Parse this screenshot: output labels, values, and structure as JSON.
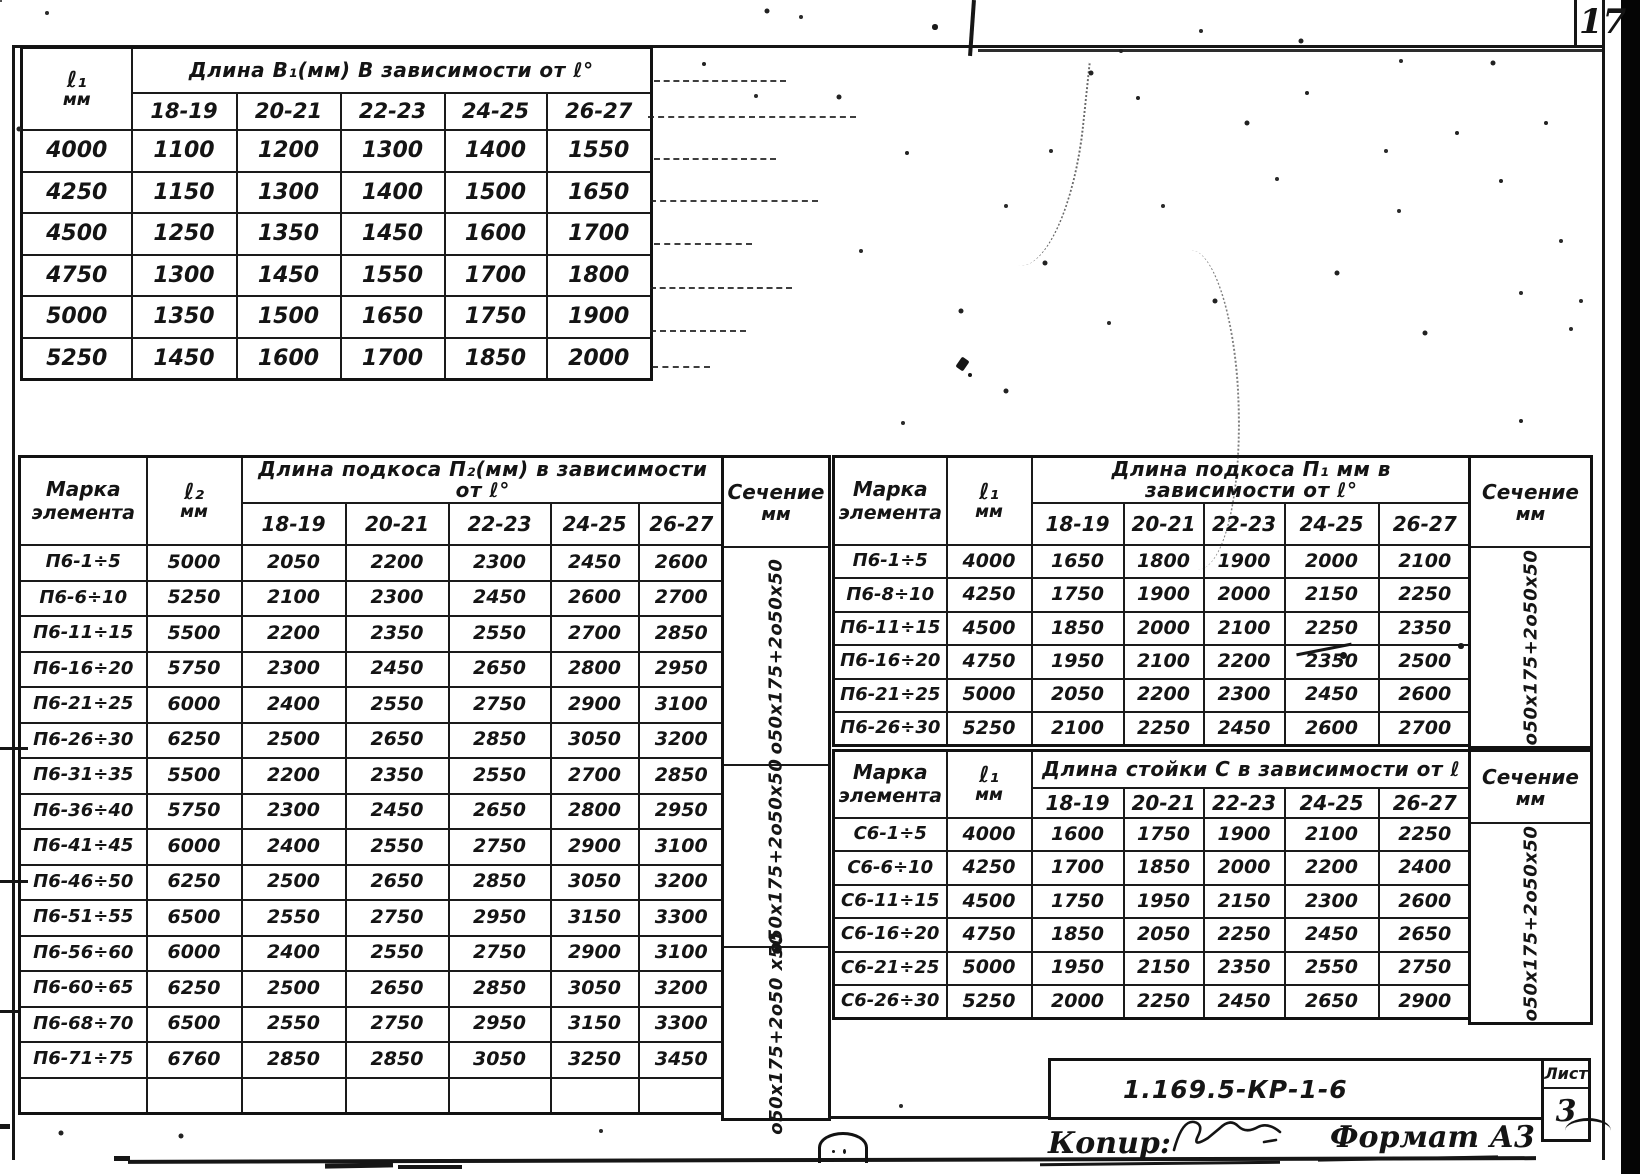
{
  "page": {
    "page_number": "17"
  },
  "top_table": {
    "corner_line1": "ℓ₁",
    "corner_line2": "мм",
    "title": "Длина В₁(мм) В зависимости от ℓ°",
    "col_headers": [
      "18-19",
      "20-21",
      "22-23",
      "24-25",
      "26-27"
    ],
    "rows": [
      {
        "label": "4000",
        "values": [
          "1100",
          "1200",
          "1300",
          "1400",
          "1550"
        ]
      },
      {
        "label": "4250",
        "values": [
          "1150",
          "1300",
          "1400",
          "1500",
          "1650"
        ]
      },
      {
        "label": "4500",
        "values": [
          "1250",
          "1350",
          "1450",
          "1600",
          "1700"
        ]
      },
      {
        "label": "4750",
        "values": [
          "1300",
          "1450",
          "1550",
          "1700",
          "1800"
        ]
      },
      {
        "label": "5000",
        "values": [
          "1350",
          "1500",
          "1650",
          "1750",
          "1900"
        ]
      },
      {
        "label": "5250",
        "values": [
          "1450",
          "1600",
          "1700",
          "1850",
          "2000"
        ]
      }
    ]
  },
  "left_table": {
    "marka_line1": "Марка",
    "marka_line2": "элемента",
    "l_line1": "ℓ₂",
    "l_line2": "мм",
    "title": "Длина подкоса П₂(мм) в зависимости от ℓ°",
    "col_headers": [
      "18-19",
      "20-21",
      "22-23",
      "24-25",
      "26-27"
    ],
    "sechenie_line1": "Сечение",
    "sechenie_line2": "мм",
    "sechenie_groups": [
      "о50х175+2о50х50",
      "о50х175+2о50х50",
      "о50х175+2о50 х50"
    ],
    "rows": [
      {
        "marka": "П6-1÷5",
        "l": "5000",
        "values": [
          "2050",
          "2200",
          "2300",
          "2450",
          "2600"
        ]
      },
      {
        "marka": "П6-6÷10",
        "l": "5250",
        "values": [
          "2100",
          "2300",
          "2450",
          "2600",
          "2700"
        ]
      },
      {
        "marka": "П6-11÷15",
        "l": "5500",
        "values": [
          "2200",
          "2350",
          "2550",
          "2700",
          "2850"
        ]
      },
      {
        "marka": "П6-16÷20",
        "l": "5750",
        "values": [
          "2300",
          "2450",
          "2650",
          "2800",
          "2950"
        ]
      },
      {
        "marka": "П6-21÷25",
        "l": "6000",
        "values": [
          "2400",
          "2550",
          "2750",
          "2900",
          "3100"
        ]
      },
      {
        "marka": "П6-26÷30",
        "l": "6250",
        "values": [
          "2500",
          "2650",
          "2850",
          "3050",
          "3200"
        ]
      },
      {
        "marka": "П6-31÷35",
        "l": "5500",
        "values": [
          "2200",
          "2350",
          "2550",
          "2700",
          "2850"
        ]
      },
      {
        "marka": "П6-36÷40",
        "l": "5750",
        "values": [
          "2300",
          "2450",
          "2650",
          "2800",
          "2950"
        ]
      },
      {
        "marka": "П6-41÷45",
        "l": "6000",
        "values": [
          "2400",
          "2550",
          "2750",
          "2900",
          "3100"
        ]
      },
      {
        "marka": "П6-46÷50",
        "l": "6250",
        "values": [
          "2500",
          "2650",
          "2850",
          "3050",
          "3200"
        ]
      },
      {
        "marka": "П6-51÷55",
        "l": "6500",
        "values": [
          "2550",
          "2750",
          "2950",
          "3150",
          "3300"
        ]
      },
      {
        "marka": "П6-56÷60",
        "l": "6000",
        "values": [
          "2400",
          "2550",
          "2750",
          "2900",
          "3100"
        ]
      },
      {
        "marka": "П6-60÷65",
        "l": "6250",
        "values": [
          "2500",
          "2650",
          "2850",
          "3050",
          "3200"
        ]
      },
      {
        "marka": "П6-68÷70",
        "l": "6500",
        "values": [
          "2550",
          "2750",
          "2950",
          "3150",
          "3300"
        ]
      },
      {
        "marka": "П6-71÷75",
        "l": "6760",
        "values": [
          "2850",
          "2850",
          "3050",
          "3250",
          "3450"
        ]
      }
    ]
  },
  "right_podkos": {
    "marka_line1": "Марка",
    "marka_line2": "элемента",
    "l_line1": "ℓ₁",
    "l_line2": "мм",
    "title": "Длина подкоса П₁ мм в зависимости от ℓ°",
    "col_headers": [
      "18-19",
      "20-21",
      "22-23",
      "24-25",
      "26-27"
    ],
    "sechenie_line1": "Сечение",
    "sechenie_line2": "мм",
    "sechenie_text": "о50х175+2о50х50",
    "rows": [
      {
        "marka": "П6-1÷5",
        "l": "4000",
        "values": [
          "1650",
          "1800",
          "1900",
          "2000",
          "2100"
        ]
      },
      {
        "marka": "П6-8÷10",
        "l": "4250",
        "values": [
          "1750",
          "1900",
          "2000",
          "2150",
          "2250"
        ]
      },
      {
        "marka": "П6-11÷15",
        "l": "4500",
        "values": [
          "1850",
          "2000",
          "2100",
          "2250",
          "2350"
        ]
      },
      {
        "marka": "П6-16÷20",
        "l": "4750",
        "values": [
          "1950",
          "2100",
          "2200",
          "2350",
          "2500"
        ]
      },
      {
        "marka": "П6-21÷25",
        "l": "5000",
        "values": [
          "2050",
          "2200",
          "2300",
          "2450",
          "2600"
        ]
      },
      {
        "marka": "П6-26÷30",
        "l": "5250",
        "values": [
          "2100",
          "2250",
          "2450",
          "2600",
          "2700"
        ]
      }
    ]
  },
  "right_stoika": {
    "marka_line1": "Марка",
    "marka_line2": "элемента",
    "l_line1": "ℓ₁",
    "l_line2": "мм",
    "title": "Длина стойки С в зависимости от ℓ",
    "col_headers": [
      "18-19",
      "20-21",
      "22-23",
      "24-25",
      "26-27"
    ],
    "sechenie_line1": "Сечение",
    "sechenie_line2": "мм",
    "sechenie_text": "о50х175+2о50х50",
    "rows": [
      {
        "marka": "С6-1÷5",
        "l": "4000",
        "values": [
          "1600",
          "1750",
          "1900",
          "2100",
          "2250"
        ]
      },
      {
        "marka": "С6-6÷10",
        "l": "4250",
        "values": [
          "1700",
          "1850",
          "2000",
          "2200",
          "2400"
        ]
      },
      {
        "marka": "С6-11÷15",
        "l": "4500",
        "values": [
          "1750",
          "1950",
          "2150",
          "2300",
          "2600"
        ]
      },
      {
        "marka": "С6-16÷20",
        "l": "4750",
        "values": [
          "1850",
          "2050",
          "2250",
          "2450",
          "2650"
        ]
      },
      {
        "marka": "С6-21÷25",
        "l": "5000",
        "values": [
          "1950",
          "2150",
          "2350",
          "2550",
          "2750"
        ]
      },
      {
        "marka": "С6-26÷30",
        "l": "5250",
        "values": [
          "2000",
          "2250",
          "2450",
          "2650",
          "2900"
        ]
      }
    ]
  },
  "title_block": {
    "doc_number": "1.169.5-КР-1-6",
    "sheet_label": "Лист",
    "sheet_number": "3"
  },
  "footer": {
    "copy_label": "Копир:",
    "format_label": "Формат А3"
  }
}
